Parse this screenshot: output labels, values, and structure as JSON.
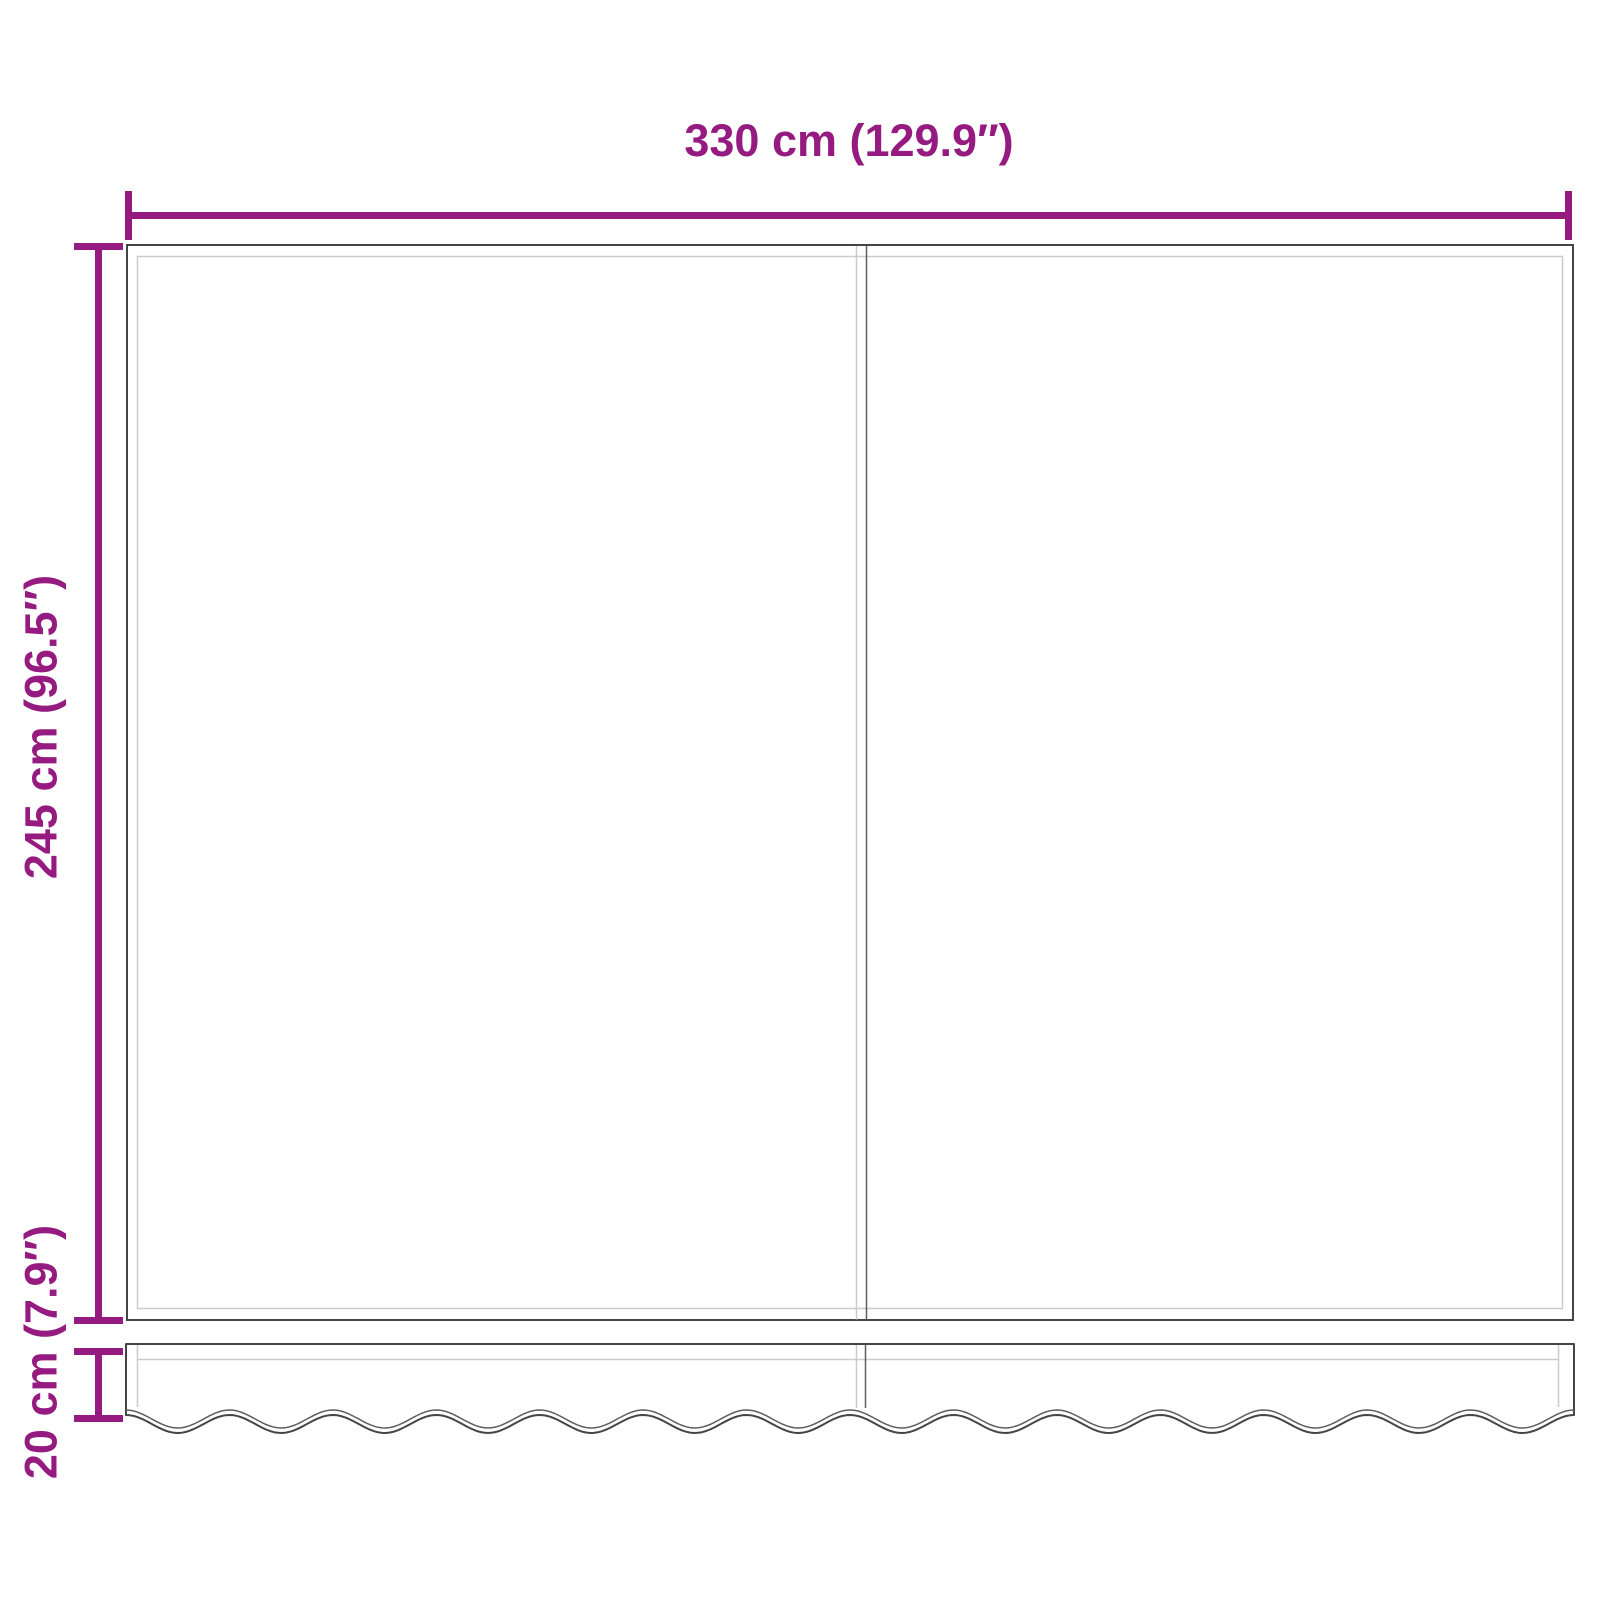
{
  "diagram": {
    "type": "product-dimension-diagram",
    "subject": "awning replacement fabric with valance",
    "width_label": "330 cm (129.9″)",
    "height_label": "245 cm (96.5″)",
    "valance_label": "20 cm (7.9″)",
    "colors": {
      "dimension_accent": "#951B81",
      "outline_dark": "#454545",
      "outline_light": "#CBCBCB",
      "seam_dark": "#5E5E5E",
      "background": "#FFFFFF"
    }
  }
}
